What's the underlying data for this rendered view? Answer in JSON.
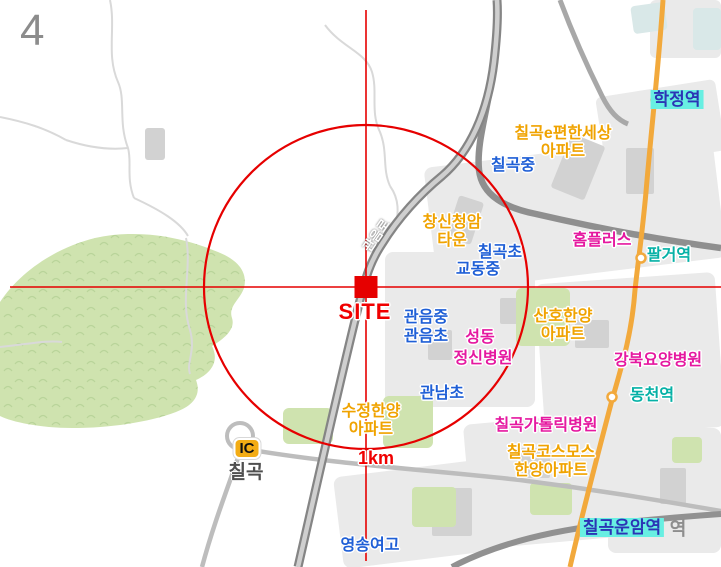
{
  "page": {
    "number": "4"
  },
  "colors": {
    "label_yellow": "#f0a300",
    "label_blue": "#1f5fd6",
    "label_magenta": "#e518a0",
    "label_teal": "#06b1a6",
    "station_bg": "#68efe2",
    "station_text": "#2b35b5",
    "overlay_red": "#e60000",
    "site_red": "#f00000",
    "road_orange": "#f2a93c",
    "green_area": "#cfe3af",
    "ic_badge_bg": "#f3ac14"
  },
  "map": {
    "site_marker": {
      "label": "SITE",
      "x": 366,
      "y": 287
    },
    "radius_circle": {
      "label": "1km",
      "radius_px": 162
    },
    "labels": [
      {
        "name": "map-label-ghost-station-suffix",
        "style": "ghost",
        "text": "역",
        "x": 678,
        "y": 519
      },
      {
        "name": "map-label-hakjeong-station",
        "style": "st",
        "text": "학정역",
        "x": 677,
        "y": 90
      },
      {
        "name": "map-label-chilgok-epyeonhansesang-apt",
        "style": "y outl",
        "lines": [
          "칠곡e편한세상",
          "아파트"
        ],
        "x": 563,
        "y": 125
      },
      {
        "name": "map-label-chilgok-middle-school",
        "style": "b outl",
        "text": "칠곡중",
        "x": 513,
        "y": 157
      },
      {
        "name": "map-label-changsin-cheongam-town",
        "style": "y outl",
        "lines": [
          "창신청암",
          "타운"
        ],
        "x": 452,
        "y": 214
      },
      {
        "name": "map-label-chilgok-elementary",
        "style": "b outl",
        "text": "칠곡초",
        "x": 500,
        "y": 244
      },
      {
        "name": "map-label-gyodong-middle-school",
        "style": "b outl",
        "text": "교동중",
        "x": 478,
        "y": 261
      },
      {
        "name": "map-label-homeplus",
        "style": "m outl",
        "text": "홈플러스",
        "x": 602,
        "y": 232
      },
      {
        "name": "map-label-palgeo-station",
        "style": "t outl",
        "text": "팔거역",
        "x": 669,
        "y": 247
      },
      {
        "name": "map-label-site",
        "style": "site outl",
        "text": "SITE",
        "x": 365,
        "y": 299
      },
      {
        "name": "map-label-gwaneum-middle-school",
        "style": "b outl",
        "text": "관음중",
        "x": 426,
        "y": 309
      },
      {
        "name": "map-label-gwaneum-elementary",
        "style": "b outl",
        "text": "관음초",
        "x": 426,
        "y": 328
      },
      {
        "name": "map-label-seongdong",
        "style": "m outl",
        "text": "성동",
        "x": 480,
        "y": 329
      },
      {
        "name": "map-label-jeongsin-hospital",
        "style": "m outl",
        "text": "정신병원",
        "x": 483,
        "y": 350
      },
      {
        "name": "map-label-sanho-hanyang-apt",
        "style": "y outl",
        "lines": [
          "산호한양",
          "아파트"
        ],
        "x": 563,
        "y": 308
      },
      {
        "name": "map-label-gangbuk-nursing-hospital",
        "style": "m outl",
        "text": "강북요양병원",
        "x": 658,
        "y": 352
      },
      {
        "name": "map-label-dongcheon-station",
        "style": "t outl",
        "text": "동천역",
        "x": 652,
        "y": 387
      },
      {
        "name": "map-label-gwannam-elementary",
        "style": "b outl",
        "text": "관남초",
        "x": 442,
        "y": 385
      },
      {
        "name": "map-label-sujeong-hanyang-apt",
        "style": "y outl",
        "lines": [
          "수정한양",
          "아파트"
        ],
        "x": 371,
        "y": 403
      },
      {
        "name": "map-label-1km",
        "style": "km outl",
        "text": "1km",
        "x": 376,
        "y": 448
      },
      {
        "name": "map-label-chilgok-catholic-hospital",
        "style": "m outl",
        "text": "칠곡가톨릭병원",
        "x": 546,
        "y": 417
      },
      {
        "name": "map-label-chilgok-cosmos-hanyang-apt",
        "style": "y outl",
        "lines": [
          "칠곡코스모스",
          "한양아파트"
        ],
        "x": 551,
        "y": 444
      },
      {
        "name": "map-label-chilgok-unam-station",
        "style": "st",
        "text": "칠곡운암역",
        "x": 622,
        "y": 518
      },
      {
        "name": "map-label-yeongsong-girls-high",
        "style": "b outl",
        "text": "영송여고",
        "x": 370,
        "y": 537
      },
      {
        "name": "ic-badge",
        "style": "ic",
        "text": "IC",
        "x": 247,
        "y": 438
      },
      {
        "name": "map-label-chilgok-ic",
        "style": "icname",
        "text": "칠곡",
        "x": 246,
        "y": 462
      },
      {
        "name": "map-label-gwaneum-ro-road",
        "style": "road",
        "text": "관음로",
        "x": 377,
        "y": 236,
        "rotate": -55
      }
    ]
  }
}
